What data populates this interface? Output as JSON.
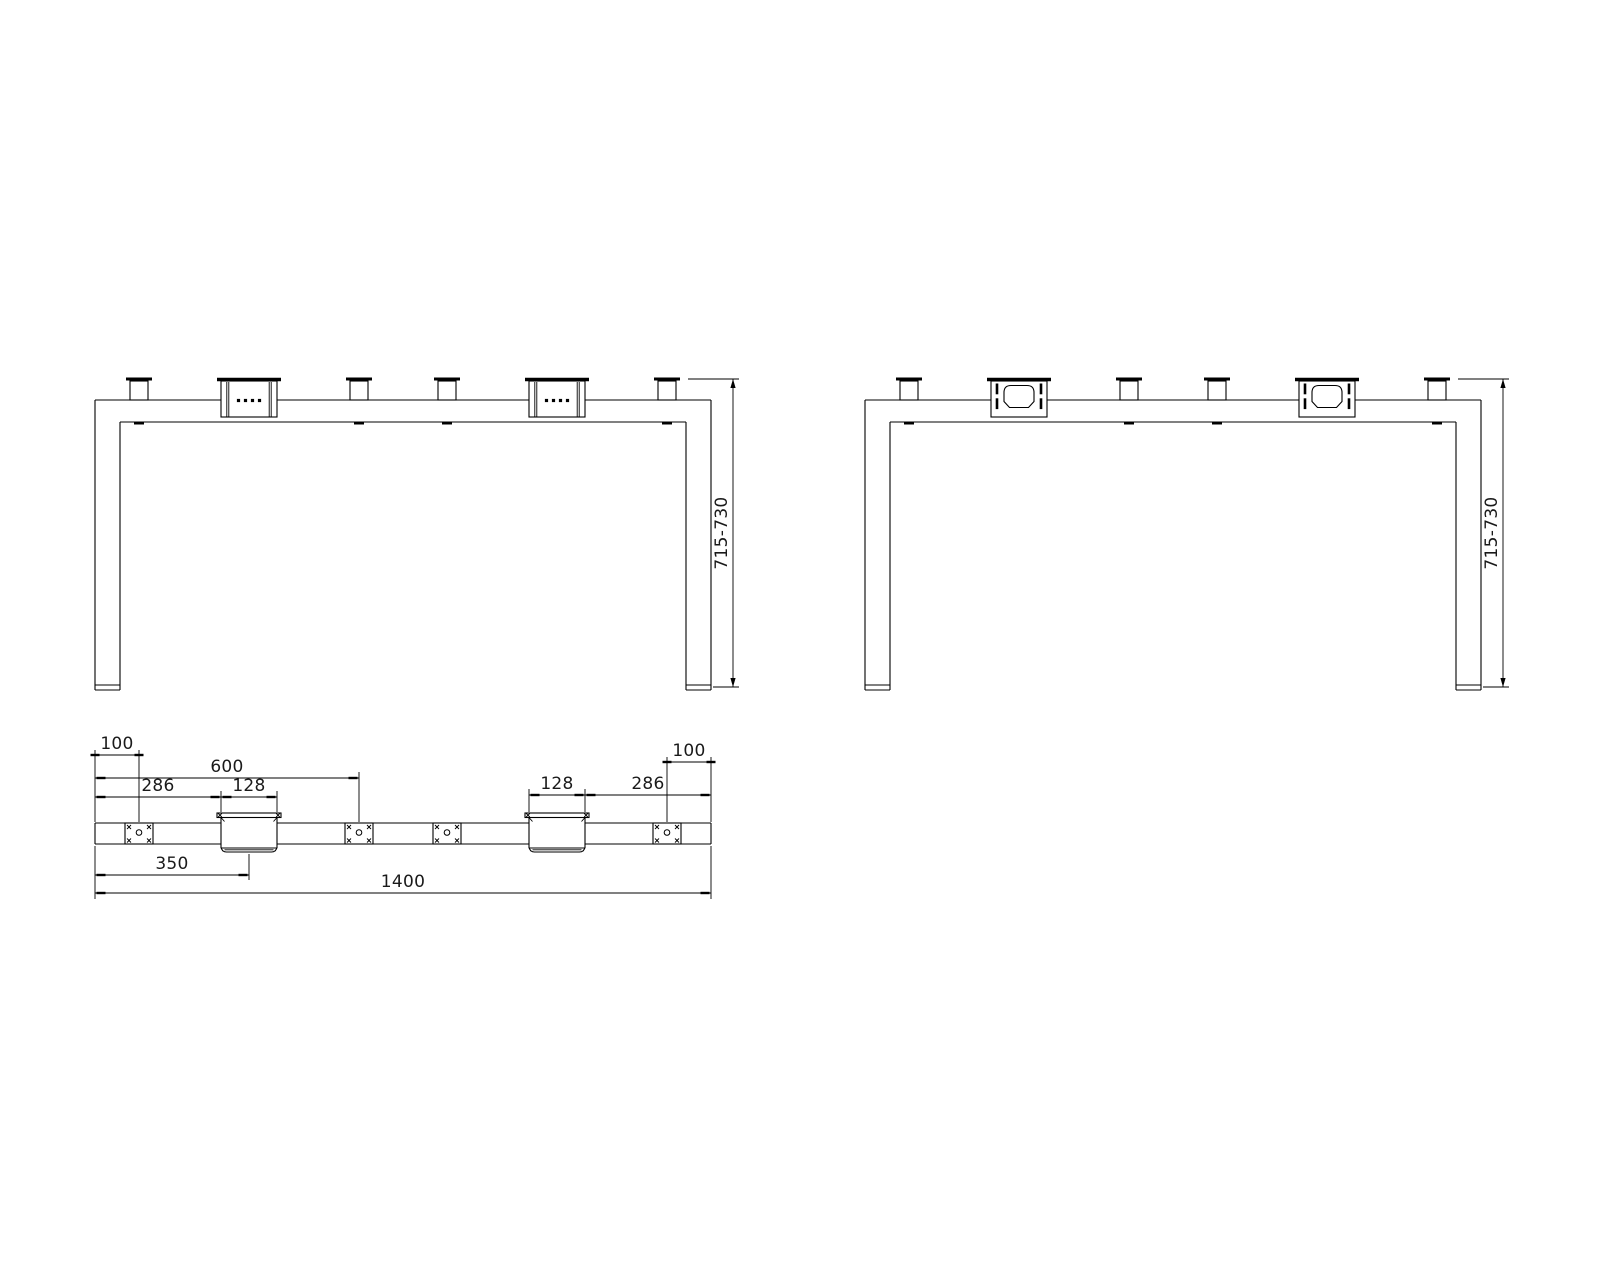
{
  "canvas": {
    "width": 1600,
    "height": 1280,
    "background": "#ffffff",
    "line_color": "#000000",
    "text_color": "#1a1a1a",
    "dim_font_size": 17
  },
  "views": {
    "front_left": {
      "id": "front-view-left",
      "x": 95,
      "bracket_style": "cable-box-dots"
    },
    "front_right": {
      "id": "front-view-right",
      "x": 865,
      "bracket_style": "cable-box-grommet"
    },
    "top": {
      "id": "top-view"
    }
  },
  "front_geom": {
    "width": 616,
    "beam_top_y": 400,
    "beam_bottom_y": 422,
    "leg_width": 25,
    "leg_bottom_y": 690,
    "foot_line_y": 685,
    "tab_centers": [
      44,
      264,
      352,
      572
    ],
    "tab_half_width": 9,
    "tab_cap_half_width": 13,
    "tab_top_y": 381,
    "cap_y": 379,
    "bracket_centers": [
      154,
      462
    ],
    "bracket_cap_half_width": 32,
    "bracket_half_width": 28,
    "bracket_bottom_y": 417,
    "liner_offsets": [
      -22.2,
      -20.2,
      20.2,
      22.2
    ],
    "dot_spacing": 7,
    "dot_size": 3.2,
    "dot_y": 400.5,
    "grommet_half_width": 15,
    "grommet_top_y": 385.5,
    "grommet_bottom_y": 407.5,
    "slot_centers_rel": [
      -22,
      22
    ],
    "slot_width": 2.6,
    "slot_height": 10.8,
    "slot_ys": [
      383.5,
      398.3
    ],
    "weld_half_width": 5,
    "weld_y": 421.5,
    "weld_height": 3
  },
  "top_geom": {
    "x": 95,
    "length": 616,
    "y_top": 823,
    "y_bottom": 844,
    "plate_centers": [
      44,
      264,
      352,
      572
    ],
    "plate_half_width": 14,
    "hole_radius": 2.8,
    "hole_cy": 832.5,
    "corner_mark_inset": 4,
    "bracket_centers": [
      154,
      462
    ],
    "flange_half_width": 32,
    "flange_top_y": 813,
    "flange_bottom_y": 817.5,
    "body_half_width": 28,
    "body_bottom_y": 848,
    "tray_half_width": 23.5,
    "tray_bottom_y": 852
  },
  "dims": {
    "h": [
      {
        "name": "dim-100-left",
        "label": "100",
        "from": 95,
        "to": 139,
        "y": 755,
        "tick_inset": 0,
        "ext": [
          [
            95,
            750,
            95,
            822
          ],
          [
            139,
            750,
            139,
            822
          ]
        ]
      },
      {
        "name": "dim-600",
        "label": "600",
        "from": 95,
        "to": 359,
        "y": 778,
        "tick_inset": 6,
        "ext": [
          [
            359,
            772,
            359,
            822
          ]
        ]
      },
      {
        "name": "dim-286-left",
        "label": "286",
        "from": 95,
        "to": 221,
        "y": 797,
        "tick_inset": 6,
        "ext": [
          [
            221,
            791,
            221,
            812
          ]
        ]
      },
      {
        "name": "dim-128-left",
        "label": "128",
        "from": 221,
        "to": 277,
        "y": 797,
        "tick_inset": 6,
        "ext": [
          [
            277,
            791,
            277,
            812
          ]
        ]
      },
      {
        "name": "dim-128-right",
        "label": "128",
        "from": 529,
        "to": 585,
        "y": 795,
        "tick_inset": 6,
        "ext": [
          [
            529,
            789,
            529,
            812
          ],
          [
            585,
            789,
            585,
            812
          ]
        ]
      },
      {
        "name": "dim-286-right",
        "label": "286",
        "from": 585,
        "to": 711,
        "y": 795,
        "tick_inset": 6,
        "ext": []
      },
      {
        "name": "dim-100-right",
        "label": "100",
        "from": 667,
        "to": 711,
        "y": 762,
        "tick_inset": 0,
        "ext": [
          [
            667,
            757,
            667,
            822
          ],
          [
            711,
            757,
            711,
            822
          ]
        ]
      },
      {
        "name": "dim-350",
        "label": "350",
        "from": 95,
        "to": 249,
        "y": 875,
        "tick_inset": 6,
        "ext": [
          [
            95,
            846,
            95,
            899
          ],
          [
            249,
            854,
            249,
            880
          ]
        ]
      },
      {
        "name": "dim-1400",
        "label": "1400",
        "from": 95,
        "to": 711,
        "y": 893,
        "tick_inset": 6,
        "ext": [
          [
            711,
            846,
            711,
            899
          ]
        ]
      }
    ],
    "v": [
      {
        "name": "dim-height-left",
        "label": "715-730",
        "x": 733,
        "from": 379,
        "to": 687,
        "ext": [
          [
            688,
            379,
            739,
            379
          ],
          [
            713,
            687,
            739,
            687
          ]
        ]
      },
      {
        "name": "dim-height-right",
        "label": "715-730",
        "x": 1503,
        "from": 379,
        "to": 687,
        "ext": [
          [
            1458,
            379,
            1509,
            379
          ],
          [
            1483,
            687,
            1509,
            687
          ]
        ]
      }
    ]
  }
}
